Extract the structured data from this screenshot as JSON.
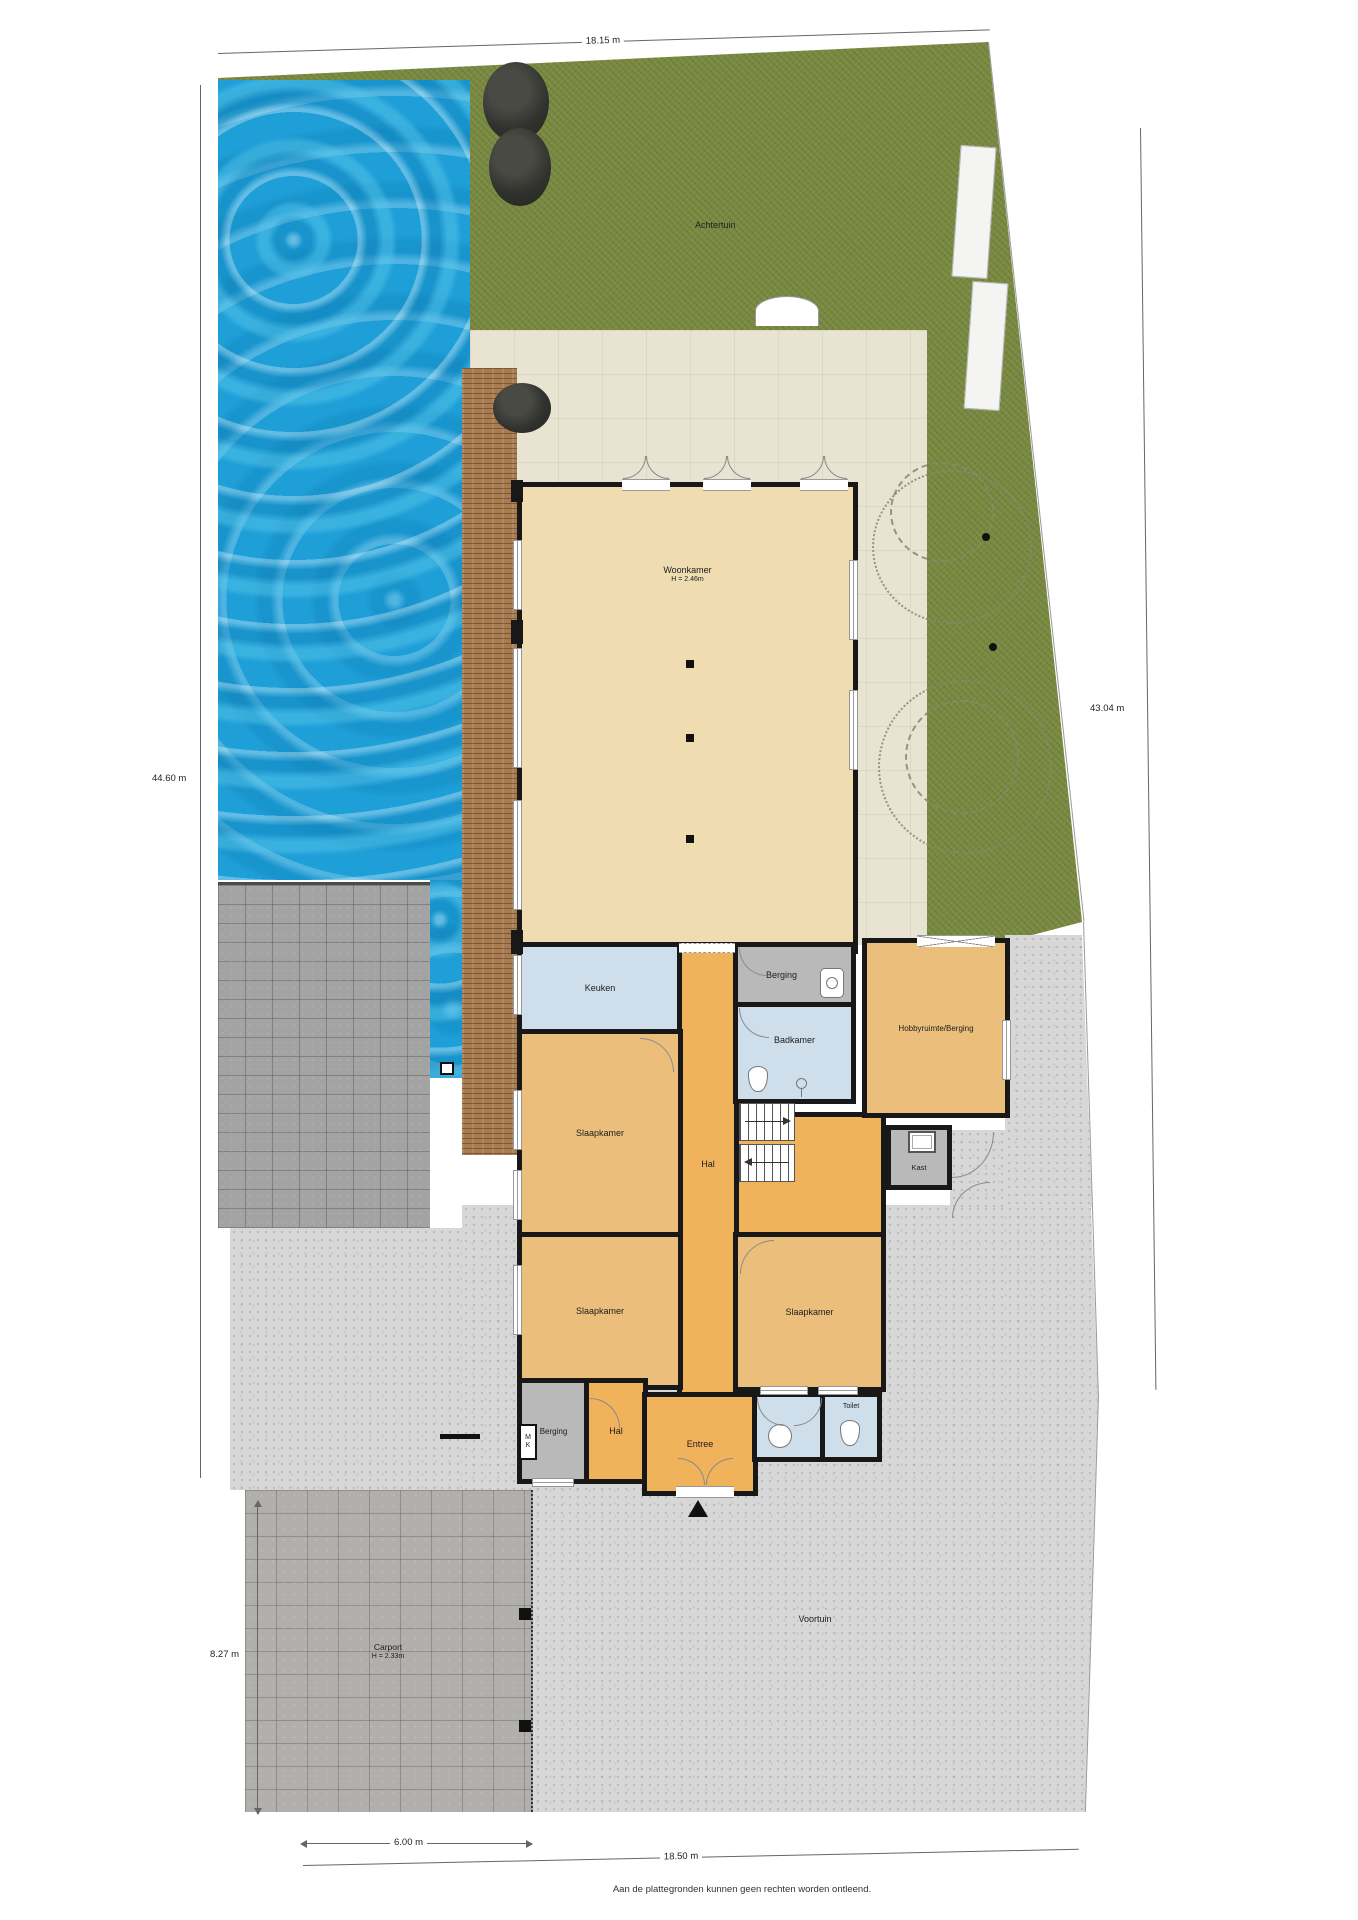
{
  "plan": {
    "dimensions": {
      "top": "18.15 m",
      "left": "44.60 m",
      "right": "43.04 m",
      "carport_side": "8.27 m",
      "bottom_inner": "6.00 m",
      "bottom_outer": "18.50 m"
    },
    "outdoor": {
      "achtertuin": "Achtertuin",
      "voortuin": "Voortuin",
      "carport_label": "Carport",
      "carport_height": "H = 2.33m"
    },
    "rooms": {
      "woonkamer": {
        "label": "Woonkamer",
        "height": "H = 2.46m"
      },
      "keuken": {
        "label": "Keuken"
      },
      "berging_top": {
        "label": "Berging"
      },
      "badkamer": {
        "label": "Badkamer"
      },
      "hobbyruimte": {
        "label": "Hobbyruimte/Berging"
      },
      "hal_main": {
        "label": "Hal"
      },
      "kast": {
        "label": "Kast"
      },
      "slaapkamer_1": {
        "label": "Slaapkamer"
      },
      "slaapkamer_2": {
        "label": "Slaapkamer"
      },
      "slaapkamer_3": {
        "label": "Slaapkamer"
      },
      "berging_bottom": {
        "label": "Berging"
      },
      "hal_bottom": {
        "label": "Hal"
      },
      "entree": {
        "label": "Entree"
      },
      "toilet": {
        "label": "Toilet"
      },
      "meterkast": {
        "line1": "M",
        "line2": "K"
      }
    },
    "disclaimer": "Aan de plattegronden kunnen geen rechten worden ontleend.",
    "colors": {
      "pool": "#1f9fd8",
      "grass": "#7a8a41",
      "terrace": "#e9e3d2",
      "deck": "#a87c50",
      "hal_orange": "#f1b25c",
      "room_tan": "#ebbf7b",
      "woonkamer_floor": "#efddb1",
      "wet_room_blue": "#cfdeeb",
      "storage_gray": "#b9b9b9",
      "paving_gray": "#a3a3a3",
      "front_paving": "#d7d7d7",
      "wall": "#181818"
    }
  }
}
